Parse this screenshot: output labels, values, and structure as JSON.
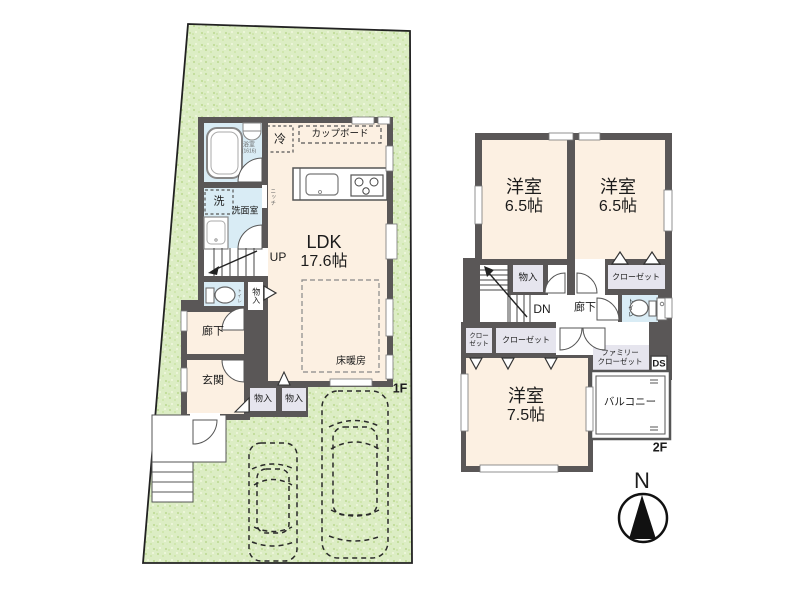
{
  "document_type": "floor-plan",
  "colors": {
    "wall": "#5a5757",
    "room_cream": "#fcf0e2",
    "water_blue": "#d9ecf5",
    "closet_gray": "#e6e5ee",
    "lot_green": "#dcedc4",
    "lot_speckle_dark": "#c3dd9d",
    "lot_speckle_light": "#ecf5d9",
    "line_dark": "#333333",
    "white": "#ffffff"
  },
  "floor1": {
    "label": "1F",
    "bathroom": {
      "name": "浴室",
      "size": "(1616)"
    },
    "laundry": "洗",
    "washroom": "洗面室",
    "niche": "ニッチ",
    "fridge": "冷",
    "cupboard": "カップボード",
    "ldk": {
      "name": "LDK",
      "size": "17.6帖"
    },
    "stairs": "UP",
    "toilet": "トイレ",
    "storage_side": "物入",
    "hallway": "廊下",
    "entrance": "玄関",
    "floor_heating": "床暖房",
    "storage_a": "物入",
    "storage_b": "物入"
  },
  "floor2": {
    "label": "2F",
    "bedroom_left": {
      "name": "洋室",
      "size": "6.5帖"
    },
    "bedroom_right": {
      "name": "洋室",
      "size": "6.5帖"
    },
    "bedroom_main": {
      "name": "洋室",
      "size": "7.5帖"
    },
    "storage": "物入",
    "closet_right": "クローゼット",
    "stairs": "DN",
    "hallway": "廊下",
    "toilet": "トイレ",
    "closet_small": {
      "line1": "クロー",
      "line2": "ゼット"
    },
    "closet_main": "クローゼット",
    "family_closet": {
      "line1": "ファミリー",
      "line2": "クローゼット"
    },
    "duct_space": "DS",
    "balcony": "バルコニー"
  },
  "compass": {
    "north": "N"
  }
}
